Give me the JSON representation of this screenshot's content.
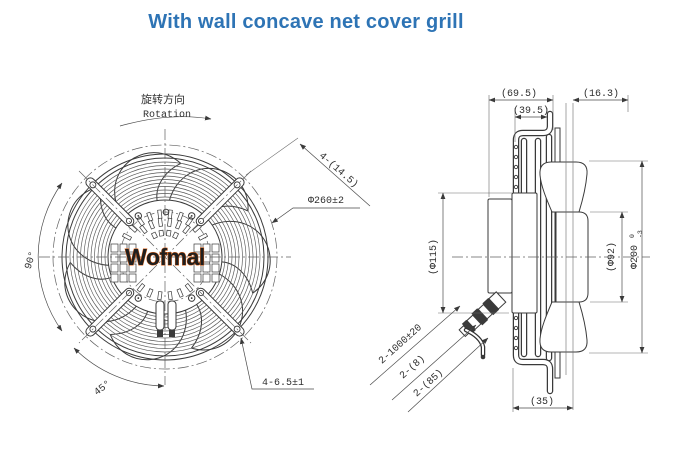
{
  "title": "With wall concave net cover grill",
  "front_view": {
    "rotation_label_cn": "旋转方向",
    "rotation_label_en": "Rotation",
    "watermark": "Wofmal",
    "dims": {
      "spoke_hole": "4-(14.5)",
      "outer_diameter": "Φ260±2",
      "angle_left": "90°",
      "angle_bottom": "45°",
      "mount_hole": "4-6.5±1"
    }
  },
  "side_view": {
    "dims": {
      "total_depth": "(69.5)",
      "net_depth": "(39.5)",
      "front_depth": "(16.3)",
      "motor_diameter": "(Φ115)",
      "hub_diameter": "(Φ92)",
      "impeller_diameter": "Φ200",
      "impeller_tol_upper": "0",
      "impeller_tol_lower": "-3",
      "cable_spec": "2-1000±20",
      "cable_dia": "2-(8)",
      "gland_length": "2-(85)",
      "foot_width": "(35)"
    }
  },
  "colors": {
    "title_blue": "#2e74b5",
    "line": "#3a3a3a",
    "watermark_stroke": "#dd5c10"
  }
}
